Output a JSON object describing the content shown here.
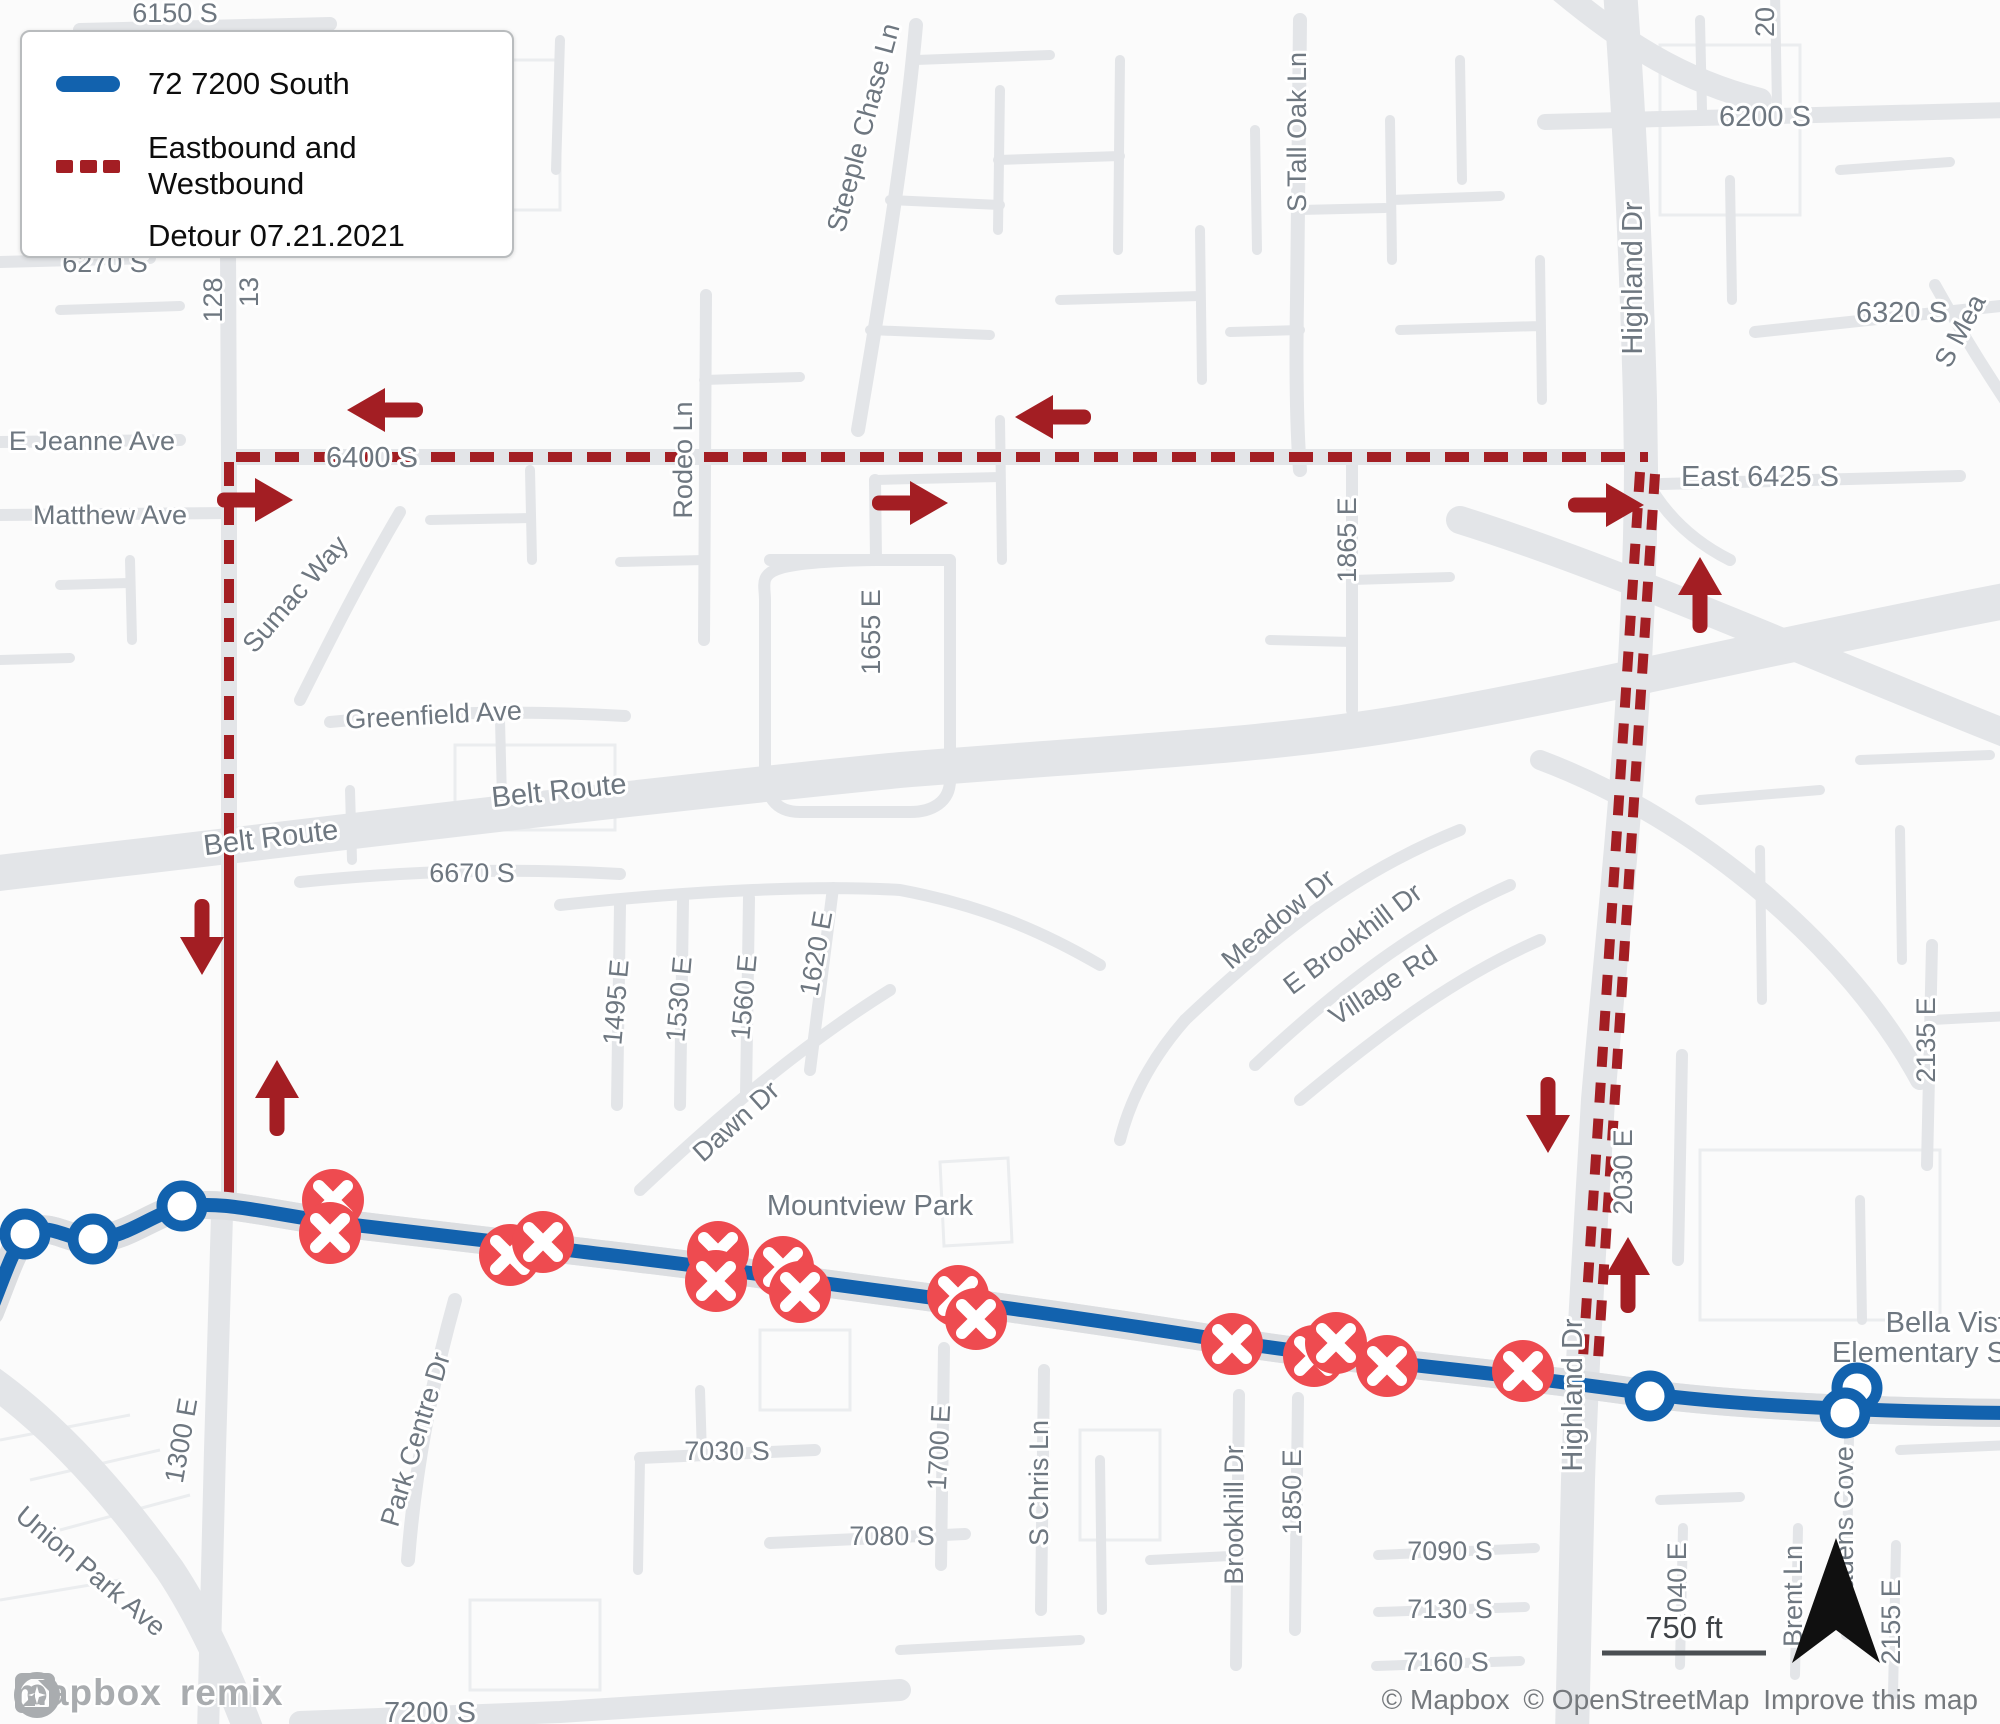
{
  "legend": {
    "route_label": "72 7200 South",
    "detour_label_line1": "Eastbound and Westbound",
    "detour_label_line2": "Detour 07.21.2021"
  },
  "colors": {
    "route_blue": "#1262ae",
    "detour_red": "#a31e23",
    "closed_stop_red": "#ee4b50",
    "road_gray": "#e3e5e8",
    "label_gray": "#6e7780",
    "background": "#fbfbfb"
  },
  "scale_bar": {
    "distance_label": "750 ft"
  },
  "attribution": {
    "part1": "© Mapbox",
    "part2": "© OpenStreetMap",
    "improve_link": "Improve this map"
  },
  "logos": {
    "mapbox": "mapbox",
    "remix": "remix"
  },
  "street_labels": {
    "s6150": "6150 S",
    "s6270": "6270 S",
    "e128": "128",
    "e13": "13",
    "jeanne": "E Jeanne Ave",
    "matthew": "Matthew Ave",
    "s6400": "6400 S",
    "sumac": "Sumac Way",
    "greenfield": "Greenfield Ave",
    "belt_route_left": "Belt Route",
    "belt_route_right": "Belt Route",
    "s6670": "6670 S",
    "rodeo": "Rodeo Ln",
    "steeple": "Steeple Chase Ln",
    "e1655": "1655 E",
    "s_tall_oak": "S Tall Oak Ln",
    "e1865": "1865 E",
    "highland_top": "Highland Dr",
    "s6200": "6200 S",
    "e20": "20",
    "s6320": "6320 S",
    "s_mea": "S Mea",
    "east6425": "East 6425 S",
    "meadow": "Meadow Dr",
    "e_brookhill": "E Brookhill Dr",
    "village": "Village Rd",
    "e2030": "2030 E",
    "e2135": "2135 E",
    "e1495": "1495 E",
    "e1530": "1530 E",
    "e1560": "1560 E",
    "e1620": "1620 E",
    "dawn": "Dawn Dr",
    "mountview": "Mountview Park",
    "e1300": "1300 E",
    "union_park": "Union Park Ave",
    "park_centre": "Park Centre Dr",
    "s7030": "7030 S",
    "s7080": "7080 S",
    "e1700": "1700 E",
    "s_chris": "S Chris Ln",
    "brookhill": "Brookhill Dr",
    "e1850": "1850 E",
    "s7090": "7090 S",
    "s7130": "7130 S",
    "s7160": "7160 S",
    "s7200": "7200 S",
    "highland_bottom": "Highland Dr",
    "e2040": "2040 E",
    "brent": "Brent Ln",
    "cadens": "Cadens Cove",
    "e2155": "2155 E",
    "bella_line1": "Bella Vist",
    "bella_line2": "Elementary S"
  }
}
